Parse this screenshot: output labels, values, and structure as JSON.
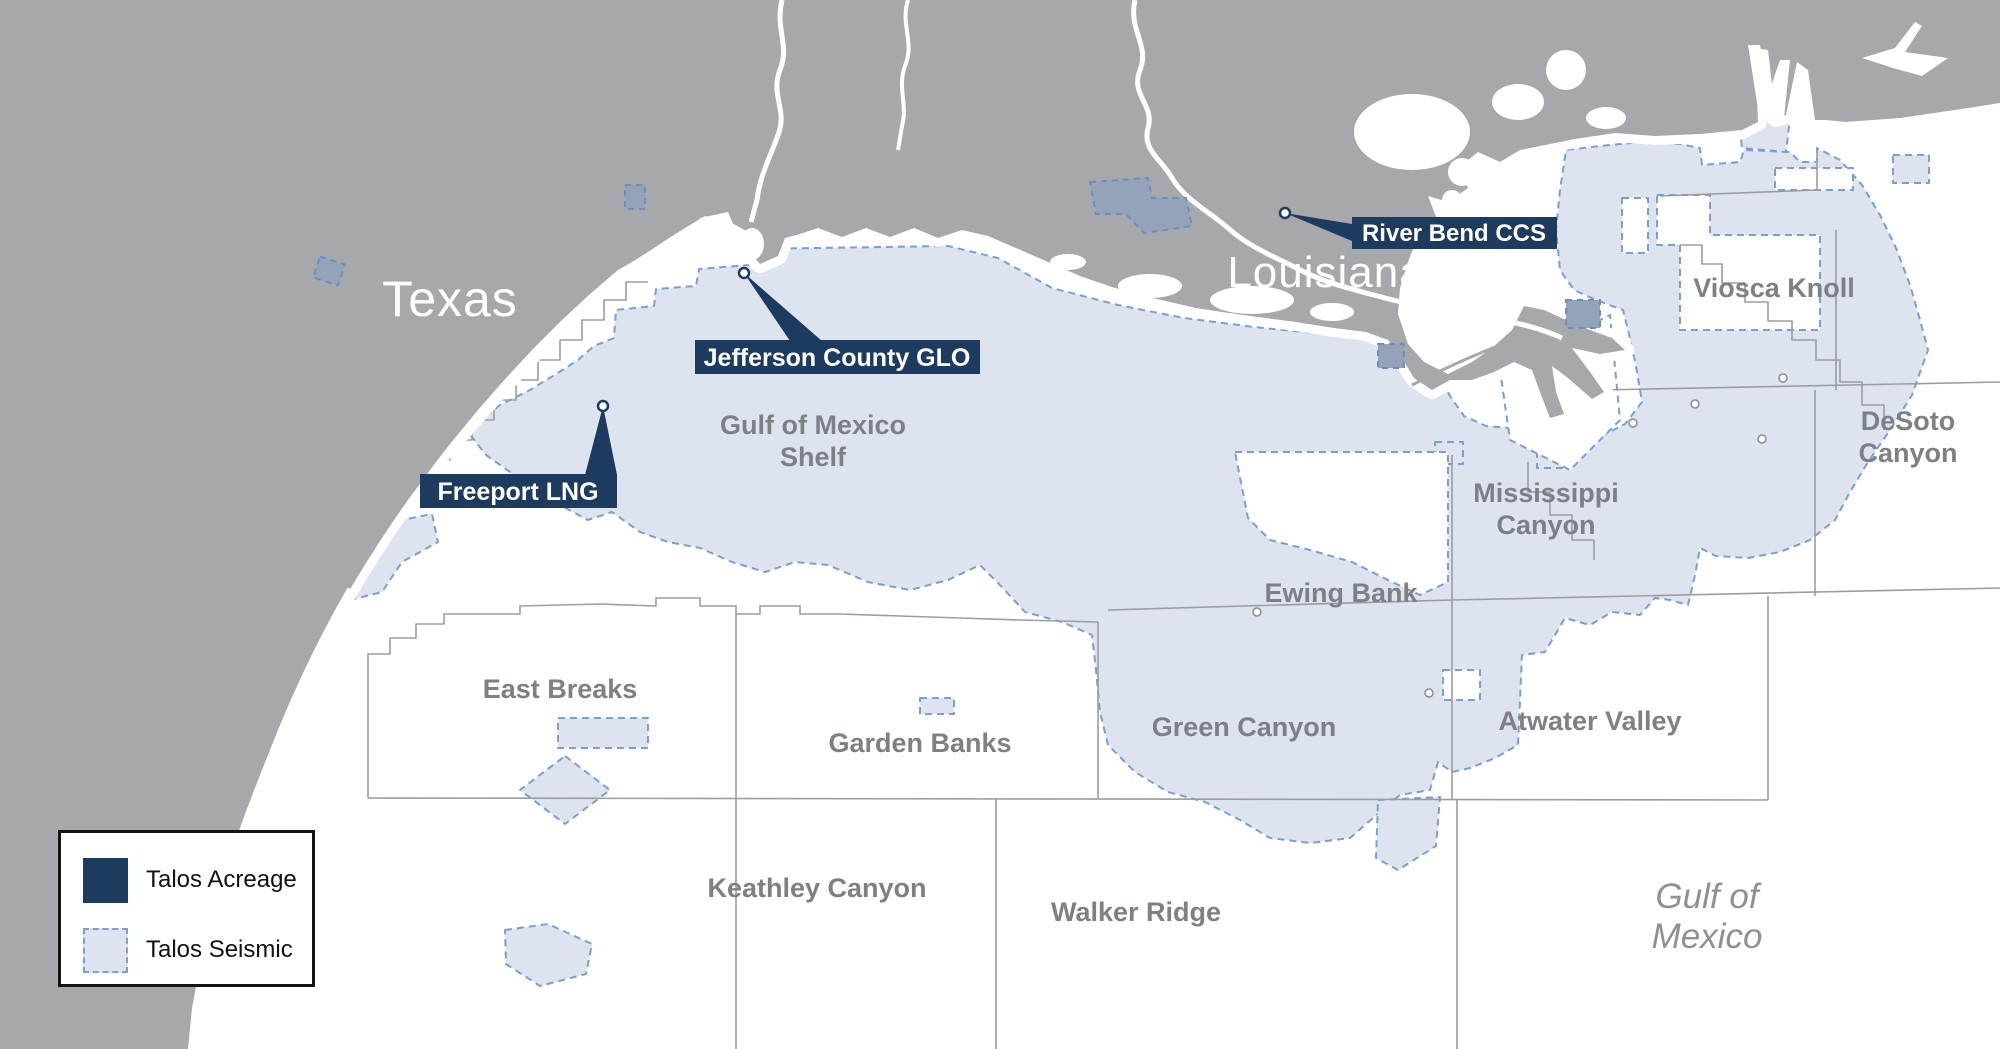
{
  "map": {
    "states": {
      "texas": "Texas",
      "louisiana": "Louisiana"
    },
    "callouts": {
      "river_bend": "River Bend CCS",
      "jefferson": "Jefferson County GLO",
      "freeport": "Freeport LNG"
    },
    "areas": {
      "gom_shelf": [
        "Gulf of Mexico",
        "Shelf"
      ],
      "viosca_knoll": "Viosca Knoll",
      "desoto_canyon": [
        "DeSoto",
        "Canyon"
      ],
      "mississippi_canyon": [
        "Mississippi",
        "Canyon"
      ],
      "ewing_bank": "Ewing Bank",
      "east_breaks": "East Breaks",
      "garden_banks": "Garden Banks",
      "green_canyon": "Green Canyon",
      "atwater_valley": "Atwater Valley",
      "keathley_canyon": "Keathley Canyon",
      "walker_ridge": "Walker Ridge",
      "gulf_of_mexico": [
        "Gulf of",
        "Mexico"
      ]
    }
  },
  "legend": {
    "items": [
      {
        "label": "Talos Acreage",
        "type": "acreage"
      },
      {
        "label": "Talos Seismic",
        "type": "seismic"
      }
    ]
  },
  "colors": {
    "land": "#a6a8ab",
    "water": "#ffffff",
    "seismic_fill": "#dde4ef",
    "seismic_stroke": "#7ba0cb",
    "acreage_navy": "#1d3a5f",
    "area_label_gray": "#7d8084",
    "grid_line": "#9b9da0"
  }
}
